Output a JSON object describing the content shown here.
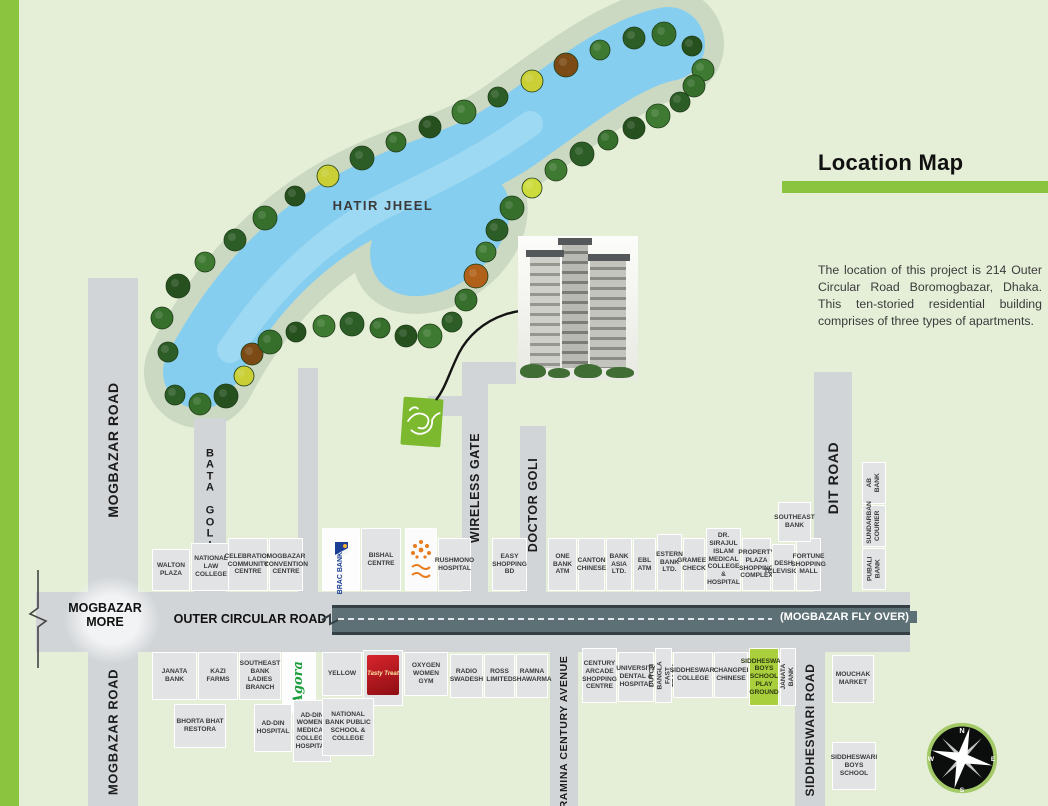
{
  "header": {
    "title": "Location Map",
    "description": "The location of this project is 214 Outer Circular Road Boromogbazar, Dhaka. This ten-storied residential building comprises of three types of apartments."
  },
  "map": {
    "lake_label": "HATIR JHEEL",
    "junction_label": "MOGBAZAR MORE",
    "outer_road_label": "OUTER CIRCULAR ROAD",
    "flyover_label": "(MOGBAZAR FLY OVER)",
    "project_marker_label": "কুটির",
    "colors": {
      "accent_green": "#8bc53f",
      "water": "#86ceef",
      "lake_band": "#cbd8c2",
      "road_gray": "#d2d5d8",
      "flyover": "#5d7076",
      "playground_green": "#a9cf3d",
      "marker_green": "#7cb92e"
    },
    "roads": [
      {
        "id": "mogbazar-road-upper",
        "label": "MOGBAZAR ROAD",
        "x": 88,
        "y": 278,
        "w": 50,
        "h": 314,
        "lx": 113,
        "ly": 450,
        "fs": 14
      },
      {
        "id": "mogbazar-road-lower",
        "label": "MOGBAZAR ROAD",
        "x": 88,
        "y": 652,
        "w": 50,
        "h": 154,
        "lx": 113,
        "ly": 732,
        "fs": 13
      },
      {
        "id": "bata-goli",
        "label": "BATA GOLI",
        "x": 194,
        "y": 418,
        "w": 32,
        "h": 174,
        "lx": 210,
        "ly": 500,
        "fs": 11,
        "stacked": true
      },
      {
        "id": "service-road",
        "label": "",
        "x": 298,
        "y": 368,
        "w": 20,
        "h": 224
      },
      {
        "id": "wireless-gate-head",
        "label": "",
        "x": 462,
        "y": 362,
        "w": 54,
        "h": 22
      },
      {
        "id": "wireless-gate-stub",
        "label": "",
        "x": 428,
        "y": 396,
        "w": 38,
        "h": 20
      },
      {
        "id": "wireless-gate",
        "label": "WIRELESS GATE",
        "x": 462,
        "y": 362,
        "w": 26,
        "h": 230,
        "lx": 475,
        "ly": 488,
        "fs": 12.5
      },
      {
        "id": "doctor-goli",
        "label": "DOCTOR GOLI",
        "x": 520,
        "y": 426,
        "w": 26,
        "h": 166,
        "lx": 533,
        "ly": 505,
        "fs": 12.5
      },
      {
        "id": "dit-road",
        "label": "DIT ROAD",
        "x": 814,
        "y": 372,
        "w": 38,
        "h": 220,
        "lx": 833,
        "ly": 478,
        "fs": 14
      },
      {
        "id": "outer-circular-road",
        "label": "",
        "x": 36,
        "y": 592,
        "w": 874,
        "h": 60
      },
      {
        "id": "ramina-century-avenue",
        "label": "RAMINA CENTURY AVENUE",
        "x": 550,
        "y": 652,
        "w": 28,
        "h": 154,
        "lx": 564,
        "ly": 732,
        "fs": 10.5
      },
      {
        "id": "siddheswari-road",
        "label": "SIDDHESWARI ROAD",
        "x": 795,
        "y": 652,
        "w": 30,
        "h": 154,
        "lx": 810,
        "ly": 730,
        "fs": 12
      }
    ],
    "landmarks": [
      {
        "id": "walton-plaza",
        "label": "WALTON PLAZA",
        "x": 152,
        "y": 549,
        "w": 38,
        "h": 42
      },
      {
        "id": "national-law-college",
        "label": "NATIONAL LAW COLLEGE",
        "x": 191,
        "y": 543,
        "w": 40,
        "h": 48
      },
      {
        "id": "celebration-community-centre",
        "label": "CELEBRATION COMMUNITY CENTRE",
        "x": 228,
        "y": 538,
        "w": 40,
        "h": 53
      },
      {
        "id": "mogbazar-convention-centre",
        "label": "MOGBAZAR CONVENTION CENTRE",
        "x": 269,
        "y": 538,
        "w": 34,
        "h": 53
      },
      {
        "id": "brac-bank",
        "label": "BRAC BANK",
        "x": 322,
        "y": 528,
        "w": 38,
        "h": 63,
        "style": "brac"
      },
      {
        "id": "bishal-centre",
        "label": "BISHAL CENTRE",
        "x": 361,
        "y": 528,
        "w": 40,
        "h": 63
      },
      {
        "id": "bengali-brand-logo",
        "label": "",
        "x": 405,
        "y": 528,
        "w": 32,
        "h": 63,
        "style": "orange"
      },
      {
        "id": "rushmono-hospital",
        "label": "RUSHMONO HOSPITAL",
        "x": 438,
        "y": 538,
        "w": 33,
        "h": 53
      },
      {
        "id": "easy-shopping-bd",
        "label": "EASY SHOPPING BD",
        "x": 492,
        "y": 538,
        "w": 35,
        "h": 53
      },
      {
        "id": "one-bank-atm",
        "label": "ONE BANK ATM",
        "x": 548,
        "y": 538,
        "w": 29,
        "h": 53
      },
      {
        "id": "canton-chinese",
        "label": "CANTON CHINESE",
        "x": 578,
        "y": 538,
        "w": 27,
        "h": 53
      },
      {
        "id": "bank-asia-ltd",
        "label": "BANK ASIA LTD.",
        "x": 606,
        "y": 538,
        "w": 26,
        "h": 53
      },
      {
        "id": "ebl-atm",
        "label": "EBL ATM",
        "x": 633,
        "y": 538,
        "w": 23,
        "h": 53
      },
      {
        "id": "estern-bank-ltd",
        "label": "ESTERN BANK LTD.",
        "x": 657,
        "y": 534,
        "w": 25,
        "h": 57
      },
      {
        "id": "grameen-check",
        "label": "GRAMEEN CHECK",
        "x": 683,
        "y": 538,
        "w": 22,
        "h": 53
      },
      {
        "id": "dr-sirajul-islam-medical",
        "label": "DR. SIRAJUL ISLAM MEDICAL COLLEGE & HOSPITAL",
        "x": 706,
        "y": 528,
        "w": 35,
        "h": 63
      },
      {
        "id": "property-plaza",
        "label": "PROPERTY PLAZA SHOPPING COMPLEX",
        "x": 742,
        "y": 538,
        "w": 29,
        "h": 53
      },
      {
        "id": "desh-television",
        "label": "DESH TELEVISION",
        "x": 772,
        "y": 544,
        "w": 23,
        "h": 47
      },
      {
        "id": "fortune-shopping-mall",
        "label": "FORTUNE SHOPPING MALL",
        "x": 796,
        "y": 538,
        "w": 25,
        "h": 53
      },
      {
        "id": "southeast-bank",
        "label": "SOUTHEAST BANK",
        "x": 778,
        "y": 502,
        "w": 33,
        "h": 40
      },
      {
        "id": "ab-bank",
        "label": "AB BANK",
        "x": 862,
        "y": 462,
        "w": 24,
        "h": 42,
        "rot": true
      },
      {
        "id": "sundarban-courier",
        "label": "SUNDARBAN COURIER",
        "x": 862,
        "y": 505,
        "w": 24,
        "h": 42,
        "rot": true
      },
      {
        "id": "pubali-bank",
        "label": "PUBALI BANK",
        "x": 862,
        "y": 548,
        "w": 24,
        "h": 42,
        "rot": true
      },
      {
        "id": "janata-bank",
        "label": "JANATA BANK",
        "x": 152,
        "y": 652,
        "w": 45,
        "h": 48
      },
      {
        "id": "kazi-farms",
        "label": "KAZI FARMS",
        "x": 198,
        "y": 652,
        "w": 40,
        "h": 48
      },
      {
        "id": "southeast-bank-ladies-branch",
        "label": "SOUTHEAST BANK LADIES BRANCH",
        "x": 239,
        "y": 652,
        "w": 42,
        "h": 48
      },
      {
        "id": "agora",
        "label": "Agora",
        "x": 282,
        "y": 652,
        "w": 34,
        "h": 62,
        "style": "agora"
      },
      {
        "id": "yellow",
        "label": "YELLOW",
        "x": 322,
        "y": 652,
        "w": 40,
        "h": 44
      },
      {
        "id": "tasty-treat",
        "label": "Tasty Treat",
        "x": 363,
        "y": 650,
        "w": 40,
        "h": 56,
        "style": "red"
      },
      {
        "id": "oxygen-women-gym",
        "label": "OXYGEN WOMEN GYM",
        "x": 404,
        "y": 652,
        "w": 44,
        "h": 44
      },
      {
        "id": "bhorta-bhat-restora",
        "label": "BHORTA BHAT RESTORA",
        "x": 174,
        "y": 704,
        "w": 52,
        "h": 44
      },
      {
        "id": "ad-din-hospital",
        "label": "AD-DIN HOSPITAL",
        "x": 254,
        "y": 704,
        "w": 38,
        "h": 48
      },
      {
        "id": "ad-din-womens-medical",
        "label": "AD-DIN WOMENS MEDICAL COLLEGE HOSPITAL",
        "x": 293,
        "y": 700,
        "w": 38,
        "h": 62
      },
      {
        "id": "national-bank-public-school",
        "label": "NATIONAL BANK PUBLIC SCHOOL & COLLEGE",
        "x": 322,
        "y": 698,
        "w": 52,
        "h": 58
      },
      {
        "id": "radio-swadesh",
        "label": "RADIO SWADESH",
        "x": 450,
        "y": 654,
        "w": 33,
        "h": 44
      },
      {
        "id": "ross-limited",
        "label": "ROSS LIMITED",
        "x": 484,
        "y": 654,
        "w": 31,
        "h": 44
      },
      {
        "id": "ramna-shawarma",
        "label": "RAMNA SHAWARMA",
        "x": 516,
        "y": 654,
        "w": 32,
        "h": 44
      },
      {
        "id": "century-arcade",
        "label": "CENTURY ARCADE SHOPPING CENTRE",
        "x": 582,
        "y": 648,
        "w": 35,
        "h": 55
      },
      {
        "id": "university-dental-hospital",
        "label": "UNIVERSITY DENTAL & HOSPITAL",
        "x": 618,
        "y": 652,
        "w": 36,
        "h": 50
      },
      {
        "id": "dutch-bangla-fast-track",
        "label": "DUTCH BANGLA FAST TRACK",
        "x": 655,
        "y": 648,
        "w": 17,
        "h": 55,
        "rot": true
      },
      {
        "id": "siddheswari-college",
        "label": "SIDDHESWARI COLLEGE",
        "x": 673,
        "y": 652,
        "w": 40,
        "h": 46
      },
      {
        "id": "changpei-chinese",
        "label": "CHANGPEI CHINESE",
        "x": 714,
        "y": 652,
        "w": 34,
        "h": 46
      },
      {
        "id": "siddheswari-boys-play-ground",
        "label": "SIDDHESWARI BOYS SCHOOL PLAY GROUND",
        "x": 749,
        "y": 648,
        "w": 30,
        "h": 58,
        "style": "green"
      },
      {
        "id": "janata-bank-2",
        "label": "JANATA BANK",
        "x": 780,
        "y": 648,
        "w": 16,
        "h": 58,
        "rot": true
      },
      {
        "id": "mouchak-market",
        "label": "MOUCHAK MARKET",
        "x": 832,
        "y": 655,
        "w": 42,
        "h": 48
      },
      {
        "id": "siddheswari-boys-school",
        "label": "SIDDHESWARI BOYS SCHOOL",
        "x": 832,
        "y": 742,
        "w": 44,
        "h": 48
      }
    ],
    "compass": {
      "north": "N",
      "east": "E",
      "south": "S",
      "west": "W"
    }
  }
}
